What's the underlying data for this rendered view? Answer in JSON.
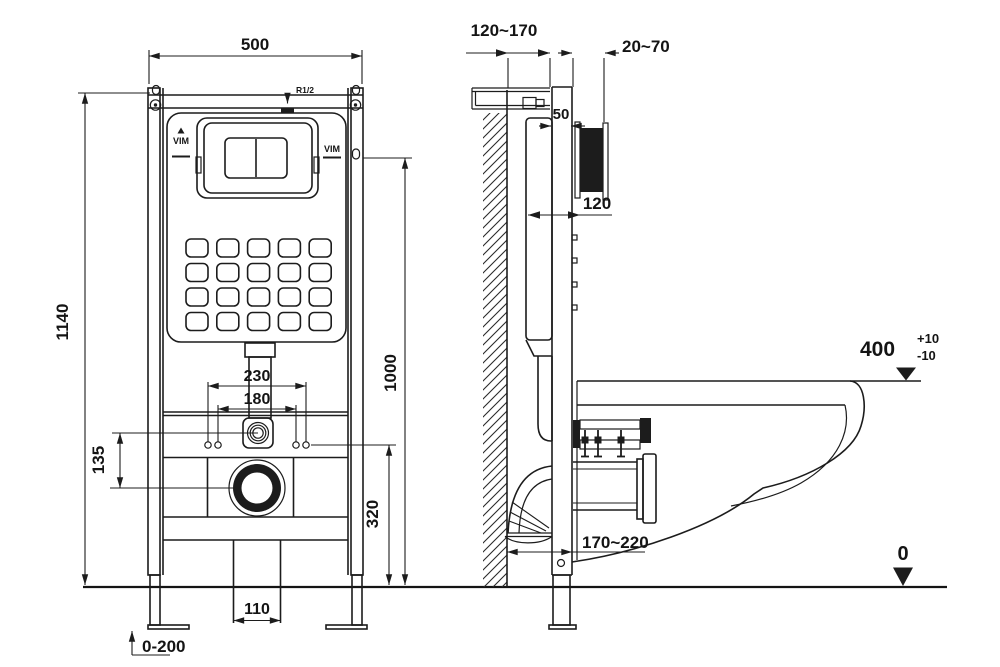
{
  "front": {
    "width": "500",
    "height": "1140",
    "inner_height": "1000",
    "bolt_spacing_outer": "230",
    "bolt_spacing_inner": "180",
    "inlet_offset": "135",
    "drain_height": "320",
    "channel_width": "110",
    "feet_range": "0-200",
    "inlet_thread": "R1/2",
    "brand": "VIM"
  },
  "side": {
    "frame_depth_range": "120~170",
    "finish_thickness_range": "20~70",
    "rail_depth": "50",
    "plate_depth": "120",
    "drain_offset_range": "170~220",
    "seat_height": "400",
    "seat_tol_plus": "+10",
    "seat_tol_minus": "-10",
    "floor_level": "0"
  }
}
